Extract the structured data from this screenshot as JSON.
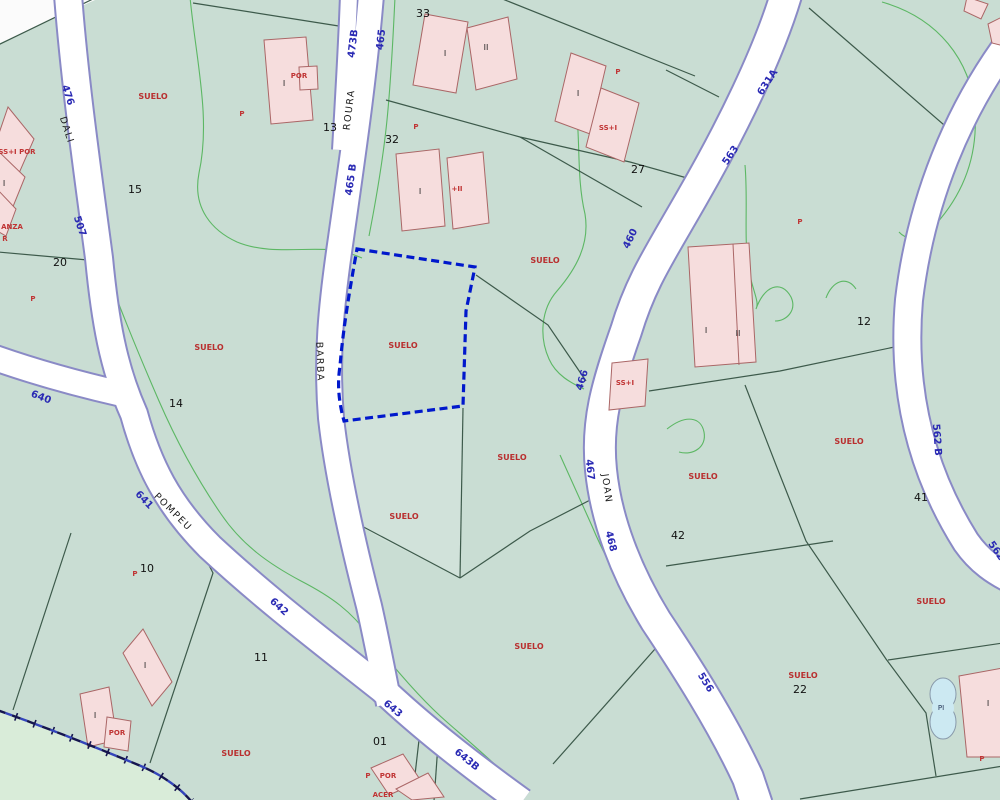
{
  "map": {
    "description": "Cadastral parcel map with a selected parcel outlined in dashed blue",
    "colors": {
      "background": "#c9ddd3",
      "lighter_zone": "#d9ecd9",
      "road_fill": "#ffffff",
      "road_casing": "#8a8ac6",
      "parcel_line": "#3d5a4b",
      "contour_green": "#49b050",
      "building_fill": "#f6dddd",
      "building_stroke": "#aa6666",
      "selected_parcel_outline": "#0018cc",
      "municipal_boundary": "#15154f",
      "road_number_text": "#2a2ab4",
      "road_name_text": "#1c1c1c",
      "parcel_number_text": "#111111",
      "land_use_text": "#b92f2f",
      "pool_fill": "#cce9f2"
    },
    "labels": {
      "road_numbers": {
        "class": "rn",
        "name": "road-number-label",
        "items": [
          {
            "t": "476",
            "x": 65,
            "y": 96,
            "r": 72
          },
          {
            "t": "507",
            "x": 77,
            "y": 227,
            "r": 72
          },
          {
            "t": "473B",
            "x": 356,
            "y": 44,
            "r": -83
          },
          {
            "t": "465",
            "x": 384,
            "y": 40,
            "r": -83
          },
          {
            "t": "465 B",
            "x": 354,
            "y": 180,
            "r": -82
          },
          {
            "t": "460",
            "x": 633,
            "y": 240,
            "r": -64
          },
          {
            "t": "466",
            "x": 585,
            "y": 381,
            "r": -73
          },
          {
            "t": "467",
            "x": 587,
            "y": 470,
            "r": 84
          },
          {
            "t": "468",
            "x": 608,
            "y": 542,
            "r": 76
          },
          {
            "t": "563",
            "x": 733,
            "y": 157,
            "r": -56
          },
          {
            "t": "631A",
            "x": 770,
            "y": 84,
            "r": -57
          },
          {
            "t": "640",
            "x": 40,
            "y": 400,
            "r": 21
          },
          {
            "t": "641",
            "x": 142,
            "y": 502,
            "r": 46
          },
          {
            "t": "642",
            "x": 277,
            "y": 609,
            "r": 42
          },
          {
            "t": "643",
            "x": 391,
            "y": 711,
            "r": 39
          },
          {
            "t": "643B",
            "x": 465,
            "y": 762,
            "r": 39
          },
          {
            "t": "556",
            "x": 703,
            "y": 684,
            "r": 58
          },
          {
            "t": "562 B",
            "x": 934,
            "y": 440,
            "r": 86
          },
          {
            "t": "562 B",
            "x": 997,
            "y": 557,
            "r": 55
          }
        ]
      },
      "road_names": {
        "class": "rname",
        "name": "road-name-label",
        "items": [
          {
            "t": "DALI",
            "x": 64,
            "y": 131,
            "r": 72
          },
          {
            "t": "ROURA",
            "x": 352,
            "y": 110,
            "r": -83
          },
          {
            "t": "BARBA",
            "x": 317,
            "y": 362,
            "r": 88
          },
          {
            "t": "POMPEU",
            "x": 171,
            "y": 514,
            "r": 45
          },
          {
            "t": "JOAN",
            "x": 604,
            "y": 489,
            "r": 82
          }
        ]
      },
      "parcel_numbers": {
        "class": "pn",
        "name": "parcel-number-label",
        "items": [
          {
            "t": "33",
            "x": 423,
            "y": 17,
            "r": 0
          },
          {
            "t": "13",
            "x": 330,
            "y": 131,
            "r": 0
          },
          {
            "t": "32",
            "x": 392,
            "y": 143,
            "r": 0
          },
          {
            "t": "27",
            "x": 638,
            "y": 173,
            "r": 0
          },
          {
            "t": "15",
            "x": 135,
            "y": 193,
            "r": 0
          },
          {
            "t": "20",
            "x": 60,
            "y": 266,
            "r": 0
          },
          {
            "t": "14",
            "x": 176,
            "y": 407,
            "r": 0
          },
          {
            "t": "12",
            "x": 864,
            "y": 325,
            "r": 0
          },
          {
            "t": "41",
            "x": 921,
            "y": 501,
            "r": 0
          },
          {
            "t": "42",
            "x": 678,
            "y": 539,
            "r": 0
          },
          {
            "t": "10",
            "x": 147,
            "y": 572,
            "r": 0
          },
          {
            "t": "11",
            "x": 261,
            "y": 661,
            "r": 0
          },
          {
            "t": "01",
            "x": 380,
            "y": 745,
            "r": 0
          },
          {
            "t": "22",
            "x": 800,
            "y": 693,
            "r": 0
          }
        ]
      },
      "land_use": {
        "class": "su",
        "name": "suelo-label",
        "items": [
          {
            "t": "SUELO",
            "x": 153,
            "y": 99,
            "r": 0
          },
          {
            "t": "SUELO",
            "x": 209,
            "y": 350,
            "r": 0
          },
          {
            "t": "SUELO",
            "x": 403,
            "y": 348,
            "r": 0
          },
          {
            "t": "SUELO",
            "x": 545,
            "y": 263,
            "r": 0
          },
          {
            "t": "SUELO",
            "x": 512,
            "y": 460,
            "r": 0
          },
          {
            "t": "SUELO",
            "x": 404,
            "y": 519,
            "r": 0
          },
          {
            "t": "SUELO",
            "x": 529,
            "y": 649,
            "r": 0
          },
          {
            "t": "SUELO",
            "x": 849,
            "y": 444,
            "r": 0
          },
          {
            "t": "SUELO",
            "x": 703,
            "y": 479,
            "r": 0
          },
          {
            "t": "SUELO",
            "x": 931,
            "y": 604,
            "r": 0
          },
          {
            "t": "SUELO",
            "x": 803,
            "y": 678,
            "r": 0
          },
          {
            "t": "SUELO",
            "x": 236,
            "y": 756,
            "r": 0
          }
        ]
      },
      "red_marks": {
        "class": "rm",
        "name": "building-use-label",
        "items": [
          {
            "t": "P",
            "x": 242,
            "y": 116,
            "r": 0
          },
          {
            "t": "P",
            "x": 416,
            "y": 129,
            "r": 0
          },
          {
            "t": "P",
            "x": 33,
            "y": 301,
            "r": 0
          },
          {
            "t": "P",
            "x": 618,
            "y": 74,
            "r": 0
          },
          {
            "t": "P",
            "x": 800,
            "y": 224,
            "r": 0
          },
          {
            "t": "P",
            "x": 135,
            "y": 576,
            "r": 0
          },
          {
            "t": "P",
            "x": 368,
            "y": 778,
            "r": 0
          },
          {
            "t": "P",
            "x": 982,
            "y": 761,
            "r": 0
          },
          {
            "t": "POR",
            "x": 299,
            "y": 78,
            "r": 0
          },
          {
            "t": "POR",
            "x": 117,
            "y": 735,
            "r": 0
          },
          {
            "t": "POR",
            "x": 388,
            "y": 778,
            "r": 0
          },
          {
            "t": "ACER",
            "x": 383,
            "y": 797,
            "r": 0
          },
          {
            "t": "SS+I",
            "x": 608,
            "y": 130,
            "r": 0
          },
          {
            "t": "SS+I",
            "x": 625,
            "y": 385,
            "r": 0
          },
          {
            "t": "+II",
            "x": 457,
            "y": 191,
            "r": 0
          },
          {
            "t": "SS+I POR",
            "x": 17,
            "y": 154,
            "r": 0
          },
          {
            "t": "ANZA",
            "x": 12,
            "y": 229,
            "r": 0
          },
          {
            "t": "R",
            "x": 5,
            "y": 241,
            "r": 0
          }
        ]
      },
      "floor_marks": {
        "class": "fm",
        "name": "building-floor-label",
        "items": [
          {
            "t": "I",
            "x": 445,
            "y": 56,
            "r": 0
          },
          {
            "t": "II",
            "x": 486,
            "y": 50,
            "r": 0
          },
          {
            "t": "I",
            "x": 284,
            "y": 86,
            "r": 0
          },
          {
            "t": "I",
            "x": 420,
            "y": 194,
            "r": 0
          },
          {
            "t": "I",
            "x": 578,
            "y": 96,
            "r": 0
          },
          {
            "t": "I",
            "x": 706,
            "y": 333,
            "r": 0
          },
          {
            "t": "II",
            "x": 738,
            "y": 336,
            "r": 0
          },
          {
            "t": "I",
            "x": 145,
            "y": 668,
            "r": 0
          },
          {
            "t": "I",
            "x": 95,
            "y": 718,
            "r": 0
          },
          {
            "t": "I",
            "x": 988,
            "y": 706,
            "r": 0
          },
          {
            "t": "I",
            "x": 4,
            "y": 186,
            "r": 0
          }
        ]
      },
      "pool": {
        "class": "pl",
        "name": "pool-label",
        "items": [
          {
            "t": "PI",
            "x": 941,
            "y": 710,
            "r": 0
          }
        ]
      }
    }
  }
}
